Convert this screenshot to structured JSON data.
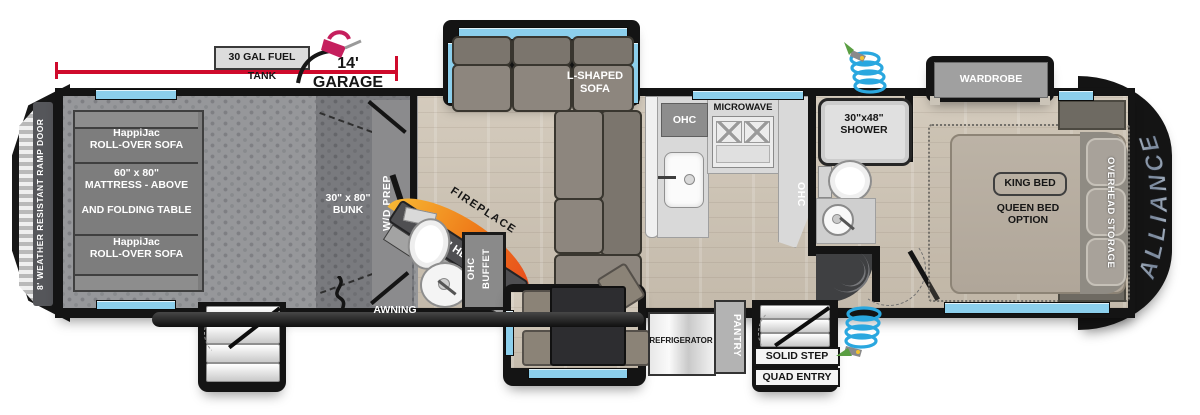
{
  "brand": {
    "name": "ALLIANCE"
  },
  "annotations": {
    "fuel_tank_label": "30 GAL FUEL TANK",
    "garage_dimension": "14' GARAGE",
    "awning": "AWNING"
  },
  "garage": {
    "ramp_door": "8' WEATHER RESISTANT RAMP DOOR",
    "sofa_top_line1": "HappiJac",
    "sofa_top_line2": "ROLL-OVER SOFA",
    "mattress_line1": "60\" x 80\"",
    "mattress_line2": "MATTRESS - ABOVE",
    "mattress_line3": "AND FOLDING TABLE",
    "sofa_bottom_line1": "HappiJac",
    "sofa_bottom_line2": "ROLL-OVER SOFA",
    "bunk_line1": "30\" x 80\"",
    "bunk_line2": "BUNK",
    "wd_prep": "W/D PREP"
  },
  "living": {
    "sofa_line1": "L-SHAPED",
    "sofa_line2": "SOFA",
    "fireplace": "FIREPLACE",
    "tv": "40\" HD TV",
    "buffet_ohc": "OHC",
    "buffet": "BUFFET"
  },
  "kitchen": {
    "ohc_left": "OHC",
    "microwave": "MICROWAVE",
    "ohc_right": "OHC"
  },
  "dining": {
    "dinette": "DINETTE",
    "refrigerator": "REFRIGERATOR",
    "pantry": "PANTRY"
  },
  "bath": {
    "shower_line1": "30\"x48\"",
    "shower_line2": "SHOWER"
  },
  "entry": {
    "step_line1": "SOLID STEP",
    "step_line2": "QUAD ENTRY"
  },
  "bedroom": {
    "wardrobe": "WARDROBE",
    "king_bed": "KING BED",
    "queen_line1": "QUEEN BED",
    "queen_line2": "OPTION",
    "overhead_storage": "OVERHEAD STORAGE"
  },
  "colors": {
    "accent_red": "#cf0a2c",
    "window_blue": "#8ccfec",
    "fuel_pink": "#c51f5d",
    "fire_orange": "#ef7d1a"
  }
}
